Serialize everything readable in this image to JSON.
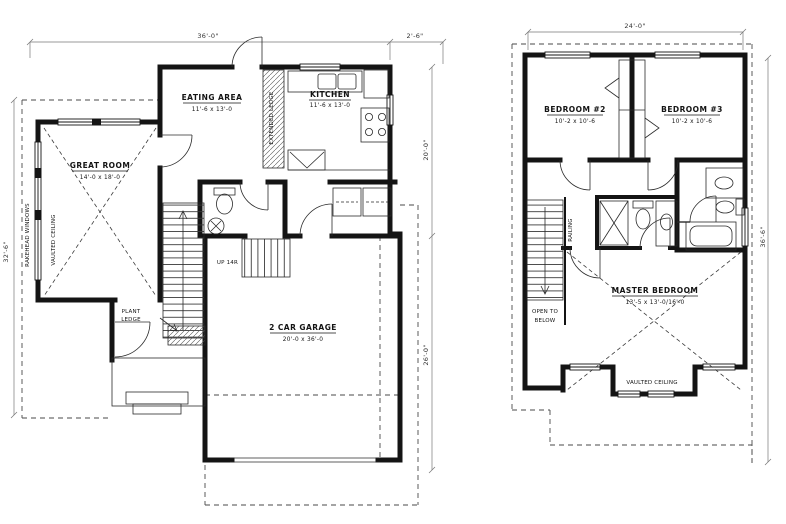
{
  "first_floor": {
    "dims": {
      "top": "36'-0\"",
      "top_right": "2'-6\"",
      "left": "32'-6\"",
      "right_upper": "20'-0\"",
      "right_lower": "26'-0\""
    },
    "great_room": {
      "name": "GREAT ROOM",
      "size": "14'-0 x 18'-0",
      "ceiling": "VAULTED CEILING",
      "windows": "RAKEHEAD WINDOWS"
    },
    "eating_area": {
      "name": "EATING AREA",
      "size": "11'-6 x 13'-0"
    },
    "kitchen": {
      "name": "KITCHEN",
      "size": "11'-6 x 13'-0",
      "ledge": "EXTENDED LEDGE"
    },
    "garage": {
      "name": "2 CAR GARAGE",
      "size": "20'-0 x 36'-0"
    },
    "plant_ledge_1": "PLANT",
    "plant_ledge_2": "LEDGE",
    "stairs_up": "UP 14R"
  },
  "second_floor": {
    "dims": {
      "top": "24'-0\"",
      "right": "36'-6\""
    },
    "bedroom2": {
      "name": "BEDROOM #2",
      "size": "10'-2 x 10'-6"
    },
    "bedroom3": {
      "name": "BEDROOM #3",
      "size": "10'-2 x 10'-6"
    },
    "master": {
      "name": "MASTER BEDROOM",
      "size": "13'-5 x 13'-0/16'-0",
      "ceiling": "VAULTED CEILING"
    },
    "open_to_1": "OPEN TO",
    "open_to_2": "BELOW",
    "railing": "RAILING"
  }
}
